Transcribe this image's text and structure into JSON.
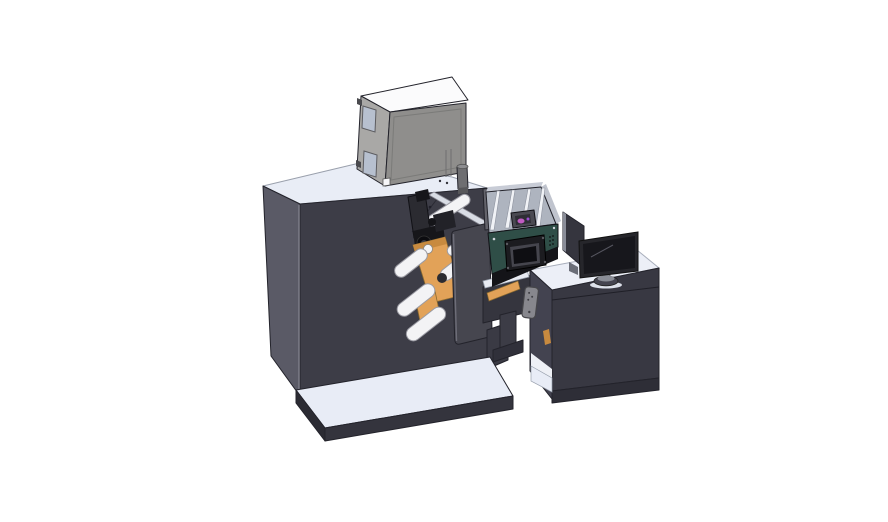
{
  "scene": {
    "type": "3d-cad-render",
    "description": "Isometric CAD rendering of a label printing and rewinding machine: a large dark cabinet with a gray feeder box on top, orange material rolls with white guide rollers, a teal inkjet print unit with a control screen, a conveyor bridge with a hanging control pendant, and an operator desk with a monitor, all standing on light base plates.",
    "objects": [
      "machine-cabinet",
      "feeder-box",
      "feeder-window",
      "feeder-filter-cylinder",
      "guide-rail",
      "print-mechanism",
      "material-roll-orange",
      "guide-roller",
      "side-plate",
      "base-plate-left",
      "conveyor-bridge",
      "support-leg",
      "inkjet-unit",
      "inkjet-tray",
      "inkjet-control-panel",
      "control-pendant",
      "operator-desk",
      "desk-shelf",
      "base-plate-right",
      "side-panel",
      "monitor",
      "monitor-stand"
    ]
  },
  "colors": {
    "background": "#ffffff",
    "machine_front": "#3d3d47",
    "machine_side": "#5a5a66",
    "machine_top": "#e9edf6",
    "slab_top": "#e8ecf6",
    "slab_front": "#34343d",
    "slab_side": "#2b2b33",
    "box_front": "#8f8e8c",
    "box_side": "#a9a8a6",
    "box_top": "#fbfbfc",
    "box_window": "#b7c0cf",
    "box_cylinder": "#6e6e71",
    "box_cyl_top": "#8d8d90",
    "box_cyl_base": "#57575a",
    "hinge_dark": "#4a4a4e",
    "white_detail": "#f6f6f8",
    "rail_guide": "#d9dde5",
    "mech_dark": "#16161a",
    "mech_mid": "#2b2b31",
    "mech_deep": "#0c0c10",
    "mech_hub": "#3c3c44",
    "roller": "#f3f3f5",
    "roller_cap": "#2b2b31",
    "core_white": "#f5f5f7",
    "orange": "#e2a258",
    "orange_dark": "#c88a3f",
    "plate": "#46464f",
    "plate_edge": "#6d6d78",
    "support": "#3a3a44",
    "support_foot": "#30303a",
    "beam": "#35353e",
    "beam_lane": "#e8ebf2",
    "leg": "#3c3c46",
    "post_gray": "#63636b",
    "tray_floor": "#aeb4bf",
    "tray_wall": "#c8ccd6",
    "tray_wall_r": "#b9bec9",
    "rail_white": "#f0f2f6",
    "carriage": "#4a4a52",
    "carriage_dark": "#2e2e35",
    "magenta": "#c05cc2",
    "violet": "#9a4fd0",
    "teal": "#2f4e47",
    "teal_under": "#141418",
    "panel_black": "#1c1c20",
    "panel_frame": "#45454d",
    "screen_black": "#0e0e12",
    "screw_light": "#cfd3da",
    "desk_top": "#eceff7",
    "desk_front": "#383842",
    "desk_side": "#434350",
    "desk_plinth": "#2e2e37",
    "desk_interior": "#eef0f6",
    "pendant": "#87878d",
    "pendant_edge": "#46464a",
    "pendant_dot": "#3e3e44",
    "panel_side": "#35353e",
    "panel_side_edge": "#8a8d98",
    "panel_foot": "#6b6e78",
    "monitor_bezel": "#26262b",
    "monitor_screen": "#17171c",
    "stand_gray": "#8a8d96",
    "stand_dark": "#454550",
    "shadow_soft": "#dde1ea",
    "corner_hilite": "#7c7c88"
  }
}
